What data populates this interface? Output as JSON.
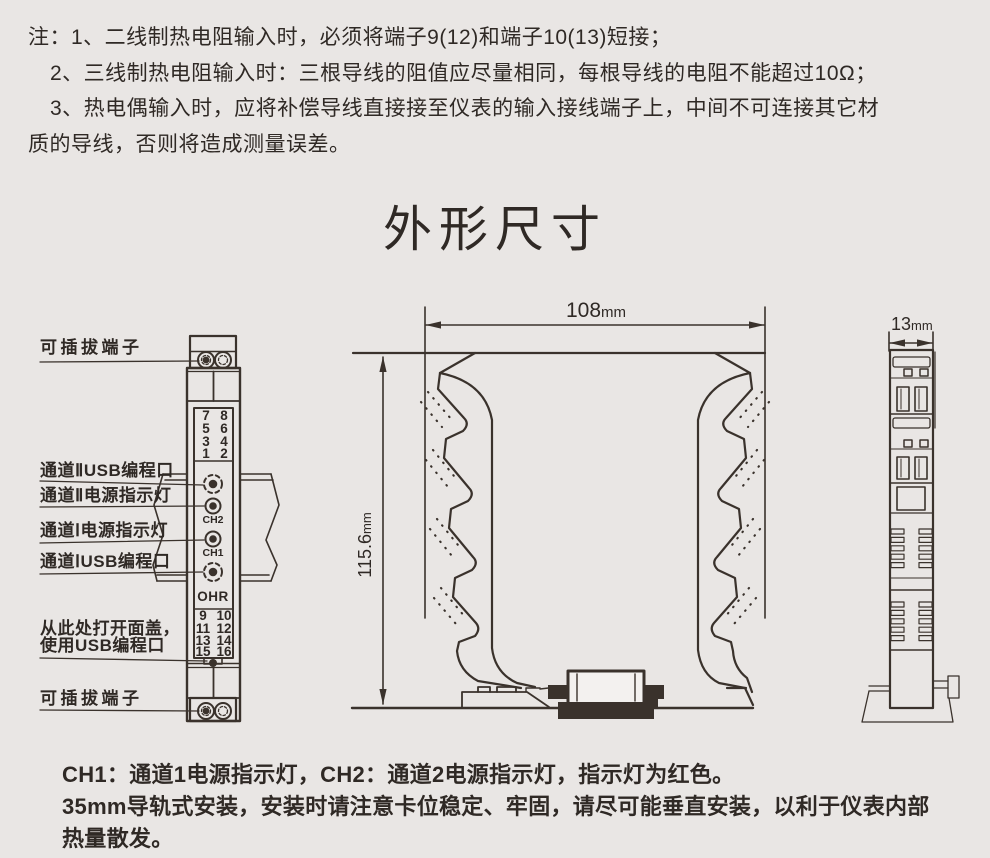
{
  "notes": {
    "l1": "注：1、二线制热电阻输入时，必须将端子9(12)和端子10(13)短接；",
    "l2": "2、三线制热电阻输入时：三根导线的阻值应尽量相同，每根导线的电阻不能超过10Ω；",
    "l3": "3、热电偶输入时，应将补偿导线直接接至仪表的输入接线端子上，中间不可连接其它材",
    "l4": "质的导线，否则将造成测量误差。"
  },
  "title": "外形尺寸",
  "front": {
    "labels": {
      "plug_top": "可插拔端子",
      "usb2": "通道ⅡUSB编程口",
      "led2": "通道Ⅱ电源指示灯",
      "led1": "通道Ⅰ电源指示灯",
      "usb1": "通道ⅠUSB编程口",
      "open1": "从此处打开面盖，",
      "open2": "使用USB编程口",
      "plug_bottom": "可插拔端子"
    },
    "ch2": "CH2",
    "ch1": "CH1",
    "logo": "OHR",
    "tt_left": [
      "7",
      "5",
      "3",
      "1"
    ],
    "tt_right": [
      "8",
      "6",
      "4",
      "2"
    ],
    "tb_left": [
      "9",
      "11",
      "13",
      "15"
    ],
    "tb_right": [
      "10",
      "12",
      "14",
      "16"
    ]
  },
  "dims": {
    "width": "108",
    "height": "115.6",
    "depth": "13",
    "unit": "mm"
  },
  "footer": {
    "l1": "CH1：通道1电源指示灯，CH2：通道2电源指示灯，指示灯为红色。",
    "l2": "35mm导轨式安装，安装时请注意卡位稳定、牢固，请尽可能垂直安装，以利于仪表内部",
    "l3": "热量散发。"
  },
  "colors": {
    "bg": "#e9e6e4",
    "line": "#3a322c",
    "text": "#2f2925"
  }
}
